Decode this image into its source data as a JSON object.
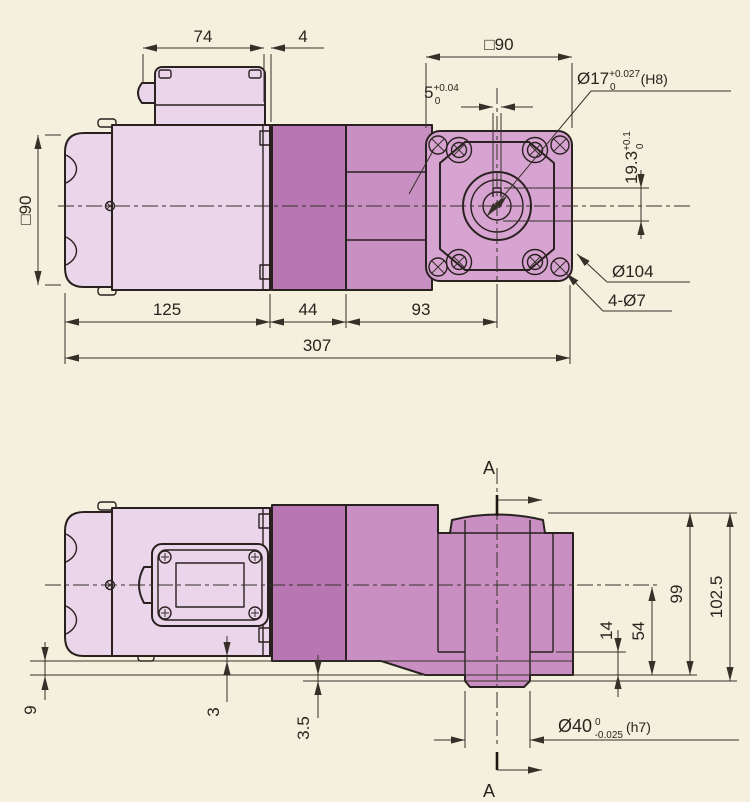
{
  "colors": {
    "background": "#f4f0dd",
    "body_light": "#ebd5eb",
    "block_dark": "#b876b2",
    "gear_mid": "#c88fc2",
    "flange": "#d7a3d1",
    "gear_side": "#c98fc3",
    "line": "#29211f",
    "dim": "#363029"
  },
  "top_view": {
    "dim_74": "74",
    "dim_4": "4",
    "square_top": "□90",
    "square_left": "□90",
    "key_width": {
      "v": "5",
      "up": "+0.04",
      "dn": "0"
    },
    "bore": {
      "v": "Ø17",
      "up": "+0.027",
      "dn": "0",
      "fit": "(H8)"
    },
    "key_depth": {
      "v": "19.3",
      "up": "+0.1",
      "dn": "0"
    },
    "pilot": "Ø104",
    "holes": "4-Ø7",
    "dim_125": "125",
    "dim_44": "44",
    "dim_93": "93",
    "dim_307": "307"
  },
  "side_view": {
    "section_top": "A",
    "section_bottom": "A",
    "dim_14": "14",
    "dim_54": "54",
    "dim_99": "99",
    "dim_102_5": "102.5",
    "dim_9": "9",
    "dim_3": "3",
    "dim_3_5": "3.5",
    "shaft": {
      "v": "Ø40",
      "up": "0",
      "dn": "-0.025",
      "fit": "(h7)"
    }
  }
}
